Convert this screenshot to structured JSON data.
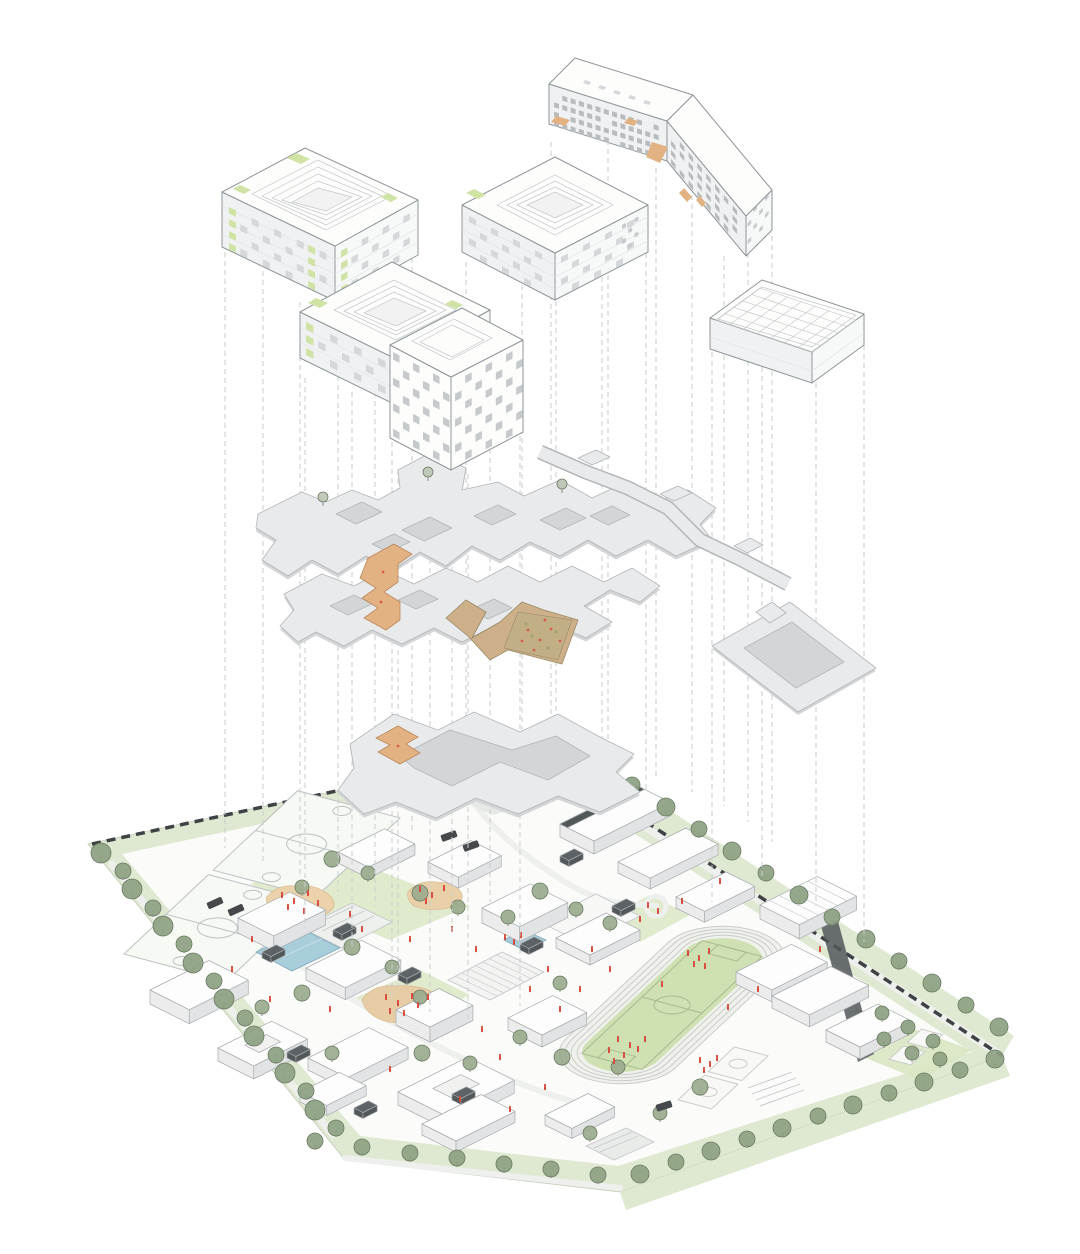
{
  "meta": {
    "type": "architectural-exploded-axonometric-diagram",
    "tiers": [
      "building-volumes",
      "roof-plates-and-ramps",
      "ground-site-plan"
    ]
  },
  "palette": {
    "paper": "#ffffff",
    "ink": "#8f969a",
    "ink_soft": "#c2c6c8",
    "bfill": "#fdfdfc",
    "bside": "#f0f1f2",
    "bside2": "#f7f8f8",
    "win": "#d4d8da",
    "win_dark": "#b7bcbe",
    "checker": "#c6cacc",
    "green": "#cfe3a5",
    "green_dark": "#a9c97e",
    "orange": "#e3b283",
    "orange_dark": "#b9885a",
    "plate": "#e9eaec",
    "plate_edge": "#b2b6b8",
    "plate_shadow": "#d3d5d7",
    "dash": "#c9cdce",
    "site_green": "#dfe8d0",
    "lawn": "#d9e5c2",
    "field": "#cfe0b2",
    "field_line": "#a8bc90",
    "track": "#f0f1ed",
    "track_line": "#c9cdc7",
    "tree": "#8da181",
    "tree_in": "#9aab8e",
    "tree_dark": "#6b7b64",
    "trunk": "#8b8f8c",
    "pool": "#a9cedb",
    "pool_dark": "#7fa8ba",
    "red": "#d6493b",
    "droof": "#52575a",
    "droof_top": "#5d6266",
    "wall": "#3e4245",
    "road": "#eef0ee",
    "plaza": "#e7e9e7",
    "mottle": "#c3af86",
    "mottle_edge": "#998a67",
    "olive": "#9aa06b",
    "blk_top": "#fcfdfc",
    "blk_left": "#ececed",
    "blk_right": "#e2e3e4",
    "blk_line": "#a8adb0",
    "vehicle": "#45494c"
  },
  "buildings": [
    {
      "id": "courtyard-building-nw",
      "kind": "courtyard block with green facade accents"
    },
    {
      "id": "courtyard-building-center",
      "kind": "courtyard block"
    },
    {
      "id": "slab-building-ne",
      "kind": "angled slab, perforated facade, orange accents"
    },
    {
      "id": "courtyard-building-west",
      "kind": "courtyard block with green facade accents"
    },
    {
      "id": "checkered-tower",
      "kind": "tower with checkerboard facade"
    },
    {
      "id": "sports-hall-roof",
      "kind": "flat hall with structural roof grid"
    }
  ],
  "plates": [
    "roof-plate-upper",
    "roof-plate-middle",
    "roof-plate-lower",
    "canopy-strip-ne",
    "canopy-ring-east"
  ],
  "ramps": [
    "switchback-ramp-west",
    "folded-play-ramp-center",
    "switchback-ramp-south"
  ],
  "projection_lines": [
    [
      225,
      252,
      848
    ],
    [
      263,
      262,
      862
    ],
    [
      300,
      302,
      876
    ],
    [
      338,
      304,
      892
    ],
    [
      375,
      284,
      906
    ],
    [
      412,
      258,
      832
    ],
    [
      305,
      378,
      928
    ],
    [
      352,
      392,
      948
    ],
    [
      398,
      470,
      986
    ],
    [
      452,
      342,
      934
    ],
    [
      490,
      314,
      902
    ],
    [
      392,
      442,
      1002
    ],
    [
      430,
      478,
      1012
    ],
    [
      468,
      474,
      1022
    ],
    [
      520,
      436,
      1006
    ],
    [
      466,
      262,
      786
    ],
    [
      522,
      258,
      806
    ],
    [
      556,
      256,
      766
    ],
    [
      602,
      232,
      776
    ],
    [
      646,
      208,
      792
    ],
    [
      551,
      142,
      762
    ],
    [
      608,
      122,
      752
    ],
    [
      656,
      168,
      780
    ],
    [
      692,
      150,
      792
    ],
    [
      724,
      256,
      806
    ],
    [
      748,
      244,
      822
    ],
    [
      772,
      236,
      842
    ],
    [
      712,
      352,
      902
    ],
    [
      762,
      304,
      882
    ],
    [
      816,
      356,
      906
    ],
    [
      864,
      318,
      942
    ]
  ],
  "grids": [
    {
      "t": "grid-b1L",
      "o": [
        229,
        207
      ],
      "dx": [
        11.3,
        5.4
      ],
      "dy": [
        0,
        12
      ],
      "cols": 9,
      "rows": 4,
      "w": 7,
      "h": 6.5,
      "sk": 0.48,
      "m": "mixed"
    },
    {
      "t": "grid-b1R",
      "o": [
        341,
        251
      ],
      "dx": [
        10.4,
        -5.7
      ],
      "dy": [
        0,
        12
      ],
      "cols": 7,
      "rows": 4,
      "w": 6.5,
      "h": 6.5,
      "sk": -0.55,
      "m": "mixed"
    },
    {
      "t": "grid-b2L",
      "o": [
        469,
        216
      ],
      "dx": [
        11.0,
        5.7
      ],
      "dy": [
        0,
        11
      ],
      "cols": 7,
      "rows": 4,
      "w": 7,
      "h": 6,
      "sk": 0.52,
      "m": "win"
    },
    {
      "t": "grid-b2R",
      "o": [
        561,
        257
      ],
      "dx": [
        11.0,
        -5.7
      ],
      "dy": [
        0,
        11
      ],
      "cols": 7,
      "rows": 4,
      "w": 7,
      "h": 6,
      "sk": -0.52,
      "m": "win"
    },
    {
      "t": "grid-b2E",
      "o": [
        622,
        225
      ],
      "dx": [
        6.2,
        -3.2
      ],
      "dy": [
        0,
        7.5
      ],
      "cols": 3,
      "rows": 4,
      "w": 4,
      "h": 4,
      "sk": -0.52,
      "m": "checker"
    },
    {
      "t": "grid-b3A",
      "o": [
        554,
        93
      ],
      "dx": [
        8.3,
        2.6
      ],
      "dy": [
        0,
        9.3
      ],
      "cols": 13,
      "rows": 4,
      "w": 5,
      "h": 5,
      "sk": 0.31,
      "m": "perf"
    },
    {
      "t": "grid-b3B",
      "o": [
        671,
        131
      ],
      "dx": [
        8.8,
        10.6
      ],
      "dy": [
        0,
        9.3
      ],
      "cols": 8,
      "rows": 4,
      "w": 4.5,
      "h": 5,
      "sk": 1.2,
      "m": "perf"
    },
    {
      "t": "grid-b3E",
      "o": [
        765,
        197
      ],
      "dx": [
        -5.8,
        5.8
      ],
      "dy": [
        0,
        8.6
      ],
      "cols": 4,
      "rows": 4,
      "w": 3.6,
      "h": 4,
      "sk": -1,
      "m": "checker"
    },
    {
      "t": "grid-b4L",
      "o": [
        306,
        322
      ],
      "dx": [
        12.0,
        5.9
      ],
      "dy": [
        0,
        13
      ],
      "cols": 7,
      "rows": 3,
      "w": 7.5,
      "h": 7,
      "sk": 0.49,
      "m": "mixed"
    },
    {
      "t": "grid-b4R",
      "o": [
        404,
        365
      ],
      "dx": [
        11.3,
        -6.1
      ],
      "dy": [
        0,
        13
      ],
      "cols": 7,
      "rows": 3,
      "w": 7,
      "h": 7,
      "sk": -0.54,
      "m": "mixed"
    },
    {
      "t": "grid-b5L",
      "o": [
        393,
        352
      ],
      "dx": [
        10.0,
        5.3
      ],
      "dy": [
        0,
        12.8
      ],
      "cols": 6,
      "rows": 7,
      "w": 6.5,
      "h": 7.5,
      "sk": 0.53,
      "m": "checker"
    },
    {
      "t": "grid-b5R",
      "o": [
        455,
        381
      ],
      "dx": [
        10.2,
        -5.3
      ],
      "dy": [
        0,
        12.8
      ],
      "cols": 7,
      "rows": 7,
      "w": 6.5,
      "h": 7.5,
      "sk": -0.52,
      "m": "checker2"
    }
  ],
  "gym_grid": {
    "o": [
      716,
      320
    ],
    "u": [
      44,
      -32
    ],
    "v": [
      96,
      32
    ],
    "nu": 5,
    "nv": 7
  },
  "blocks": [
    [
      150,
      990,
      66,
      44,
      14,
      0
    ],
    [
      238,
      918,
      58,
      40,
      15,
      0
    ],
    [
      306,
      968,
      62,
      44,
      12,
      0
    ],
    [
      218,
      1048,
      60,
      40,
      13,
      1
    ],
    [
      308,
      1058,
      68,
      44,
      12,
      0
    ],
    [
      396,
      1010,
      48,
      38,
      15,
      0
    ],
    [
      398,
      1092,
      78,
      52,
      13,
      1
    ],
    [
      482,
      908,
      54,
      42,
      15,
      0
    ],
    [
      428,
      862,
      48,
      34,
      11,
      0
    ],
    [
      338,
      852,
      52,
      34,
      11,
      0
    ],
    [
      508,
      1018,
      50,
      38,
      12,
      0
    ],
    [
      556,
      938,
      56,
      38,
      10,
      0
    ],
    [
      545,
      1115,
      48,
      30,
      10,
      0
    ],
    [
      560,
      824,
      86,
      38,
      13,
      2
    ],
    [
      618,
      862,
      76,
      36,
      11,
      0
    ],
    [
      676,
      897,
      56,
      32,
      11,
      0
    ],
    [
      736,
      972,
      62,
      40,
      12,
      0
    ],
    [
      772,
      996,
      66,
      42,
      12,
      0
    ],
    [
      826,
      1030,
      58,
      38,
      12,
      0
    ],
    [
      422,
      1124,
      66,
      38,
      11,
      0
    ],
    [
      300,
      1092,
      44,
      30,
      10,
      0
    ],
    [
      760,
      905,
      64,
      44,
      14,
      3
    ]
  ],
  "monitors": [
    [
      262,
      952
    ],
    [
      333,
      930
    ],
    [
      398,
      974
    ],
    [
      287,
      1052
    ],
    [
      354,
      1108
    ],
    [
      452,
      1094
    ],
    [
      520,
      944
    ],
    [
      560,
      856
    ],
    [
      612,
      906
    ]
  ],
  "trees": {
    "perimeter_west": [
      [
        101,
        862
      ],
      [
        123,
        880
      ],
      [
        132,
        898
      ],
      [
        153,
        917
      ],
      [
        163,
        935
      ],
      [
        184,
        953
      ],
      [
        193,
        972
      ],
      [
        214,
        990
      ],
      [
        224,
        1008
      ],
      [
        245,
        1027
      ],
      [
        254,
        1045
      ],
      [
        276,
        1064
      ],
      [
        285,
        1082
      ],
      [
        306,
        1100
      ],
      [
        315,
        1119
      ],
      [
        336,
        1137
      ]
    ],
    "perimeter_ne": [
      [
        599,
        772
      ],
      [
        632,
        794
      ],
      [
        666,
        816
      ],
      [
        699,
        838
      ],
      [
        732,
        860
      ],
      [
        766,
        882
      ],
      [
        799,
        904
      ],
      [
        832,
        926
      ],
      [
        866,
        948
      ],
      [
        899,
        970
      ],
      [
        932,
        992
      ],
      [
        966,
        1014
      ],
      [
        999,
        1036
      ]
    ],
    "perimeter_se": [
      [
        995,
        1068
      ],
      [
        960,
        1079
      ],
      [
        924,
        1091
      ],
      [
        889,
        1102
      ],
      [
        853,
        1114
      ],
      [
        818,
        1125
      ],
      [
        782,
        1137
      ],
      [
        747,
        1148
      ],
      [
        711,
        1160
      ],
      [
        676,
        1171
      ],
      [
        640,
        1183
      ]
    ],
    "perimeter_south": [
      [
        598,
        1184
      ],
      [
        551,
        1178
      ],
      [
        504,
        1173
      ],
      [
        457,
        1167
      ],
      [
        410,
        1162
      ],
      [
        362,
        1156
      ],
      [
        315,
        1150
      ]
    ],
    "east_corner": [
      [
        882,
        1022
      ],
      [
        908,
        1036
      ],
      [
        933,
        1050
      ],
      [
        912,
        1062
      ],
      [
        884,
        1048
      ],
      [
        940,
        1068
      ]
    ],
    "interior": [
      [
        332,
        868
      ],
      [
        368,
        882
      ],
      [
        302,
        896
      ],
      [
        420,
        902
      ],
      [
        458,
        916
      ],
      [
        508,
        926
      ],
      [
        540,
        900
      ],
      [
        576,
        918
      ],
      [
        610,
        932
      ],
      [
        352,
        956
      ],
      [
        392,
        976
      ],
      [
        420,
        1006
      ],
      [
        302,
        1002
      ],
      [
        262,
        1016
      ],
      [
        332,
        1062
      ],
      [
        422,
        1062
      ],
      [
        470,
        1072
      ],
      [
        520,
        1046
      ],
      [
        562,
        1066
      ],
      [
        618,
        1076
      ],
      [
        660,
        1122
      ],
      [
        700,
        1096
      ],
      [
        590,
        1142
      ],
      [
        560,
        992
      ]
    ]
  },
  "plate_trees": [
    [
      428,
      481
    ],
    [
      323,
      506
    ],
    [
      562,
      493
    ]
  ],
  "vehicles": [
    [
      215,
      903,
      -24
    ],
    [
      236,
      910,
      -24
    ],
    [
      449,
      836,
      -20
    ],
    [
      471,
      846,
      -20
    ],
    [
      664,
      1106,
      -18
    ]
  ],
  "figures": [
    [
      282,
      896
    ],
    [
      294,
      902
    ],
    [
      308,
      894
    ],
    [
      288,
      908
    ],
    [
      304,
      912
    ],
    [
      318,
      904
    ],
    [
      420,
      890
    ],
    [
      432,
      896
    ],
    [
      444,
      889
    ],
    [
      426,
      902
    ],
    [
      386,
      998
    ],
    [
      398,
      1004
    ],
    [
      412,
      997
    ],
    [
      390,
      1012
    ],
    [
      404,
      1014
    ],
    [
      418,
      1006
    ],
    [
      428,
      998
    ],
    [
      688,
      954
    ],
    [
      699,
      959
    ],
    [
      709,
      952
    ],
    [
      694,
      965
    ],
    [
      705,
      967
    ],
    [
      618,
      1040
    ],
    [
      630,
      1046
    ],
    [
      609,
      1051
    ],
    [
      624,
      1056
    ],
    [
      638,
      1050
    ],
    [
      614,
      1062
    ],
    [
      645,
      1040
    ],
    [
      700,
      1061
    ],
    [
      710,
      1065
    ],
    [
      717,
      1059
    ],
    [
      704,
      1071
    ],
    [
      505,
      938
    ],
    [
      514,
      943
    ],
    [
      521,
      936
    ],
    [
      648,
      906
    ],
    [
      658,
      912
    ],
    [
      452,
      930
    ],
    [
      476,
      950
    ],
    [
      548,
      970
    ],
    [
      580,
      990
    ],
    [
      640,
      920
    ],
    [
      592,
      950
    ],
    [
      362,
      930
    ],
    [
      252,
      940
    ],
    [
      232,
      970
    ],
    [
      482,
      1030
    ],
    [
      500,
      1058
    ],
    [
      545,
      1088
    ],
    [
      662,
      985
    ],
    [
      728,
      1008
    ],
    [
      758,
      990
    ],
    [
      682,
      902
    ],
    [
      720,
      882
    ],
    [
      820,
      950
    ],
    [
      560,
      1010
    ],
    [
      530,
      990
    ],
    [
      610,
      970
    ],
    [
      350,
      915
    ],
    [
      270,
      1000
    ],
    [
      410,
      940
    ],
    [
      330,
      1010
    ],
    [
      390,
      1070
    ],
    [
      460,
      1100
    ],
    [
      510,
      1110
    ]
  ],
  "ramp_speckles": {
    "red": [
      [
        528,
        630
      ],
      [
        540,
        640
      ],
      [
        551,
        629
      ],
      [
        534,
        650
      ],
      [
        560,
        641
      ],
      [
        545,
        620
      ],
      [
        522,
        641
      ],
      [
        383,
        572
      ],
      [
        381,
        602
      ],
      [
        398,
        746
      ]
    ],
    "olive": [
      [
        532,
        636
      ],
      [
        548,
        648
      ],
      [
        556,
        632
      ],
      [
        526,
        624
      ]
    ]
  }
}
